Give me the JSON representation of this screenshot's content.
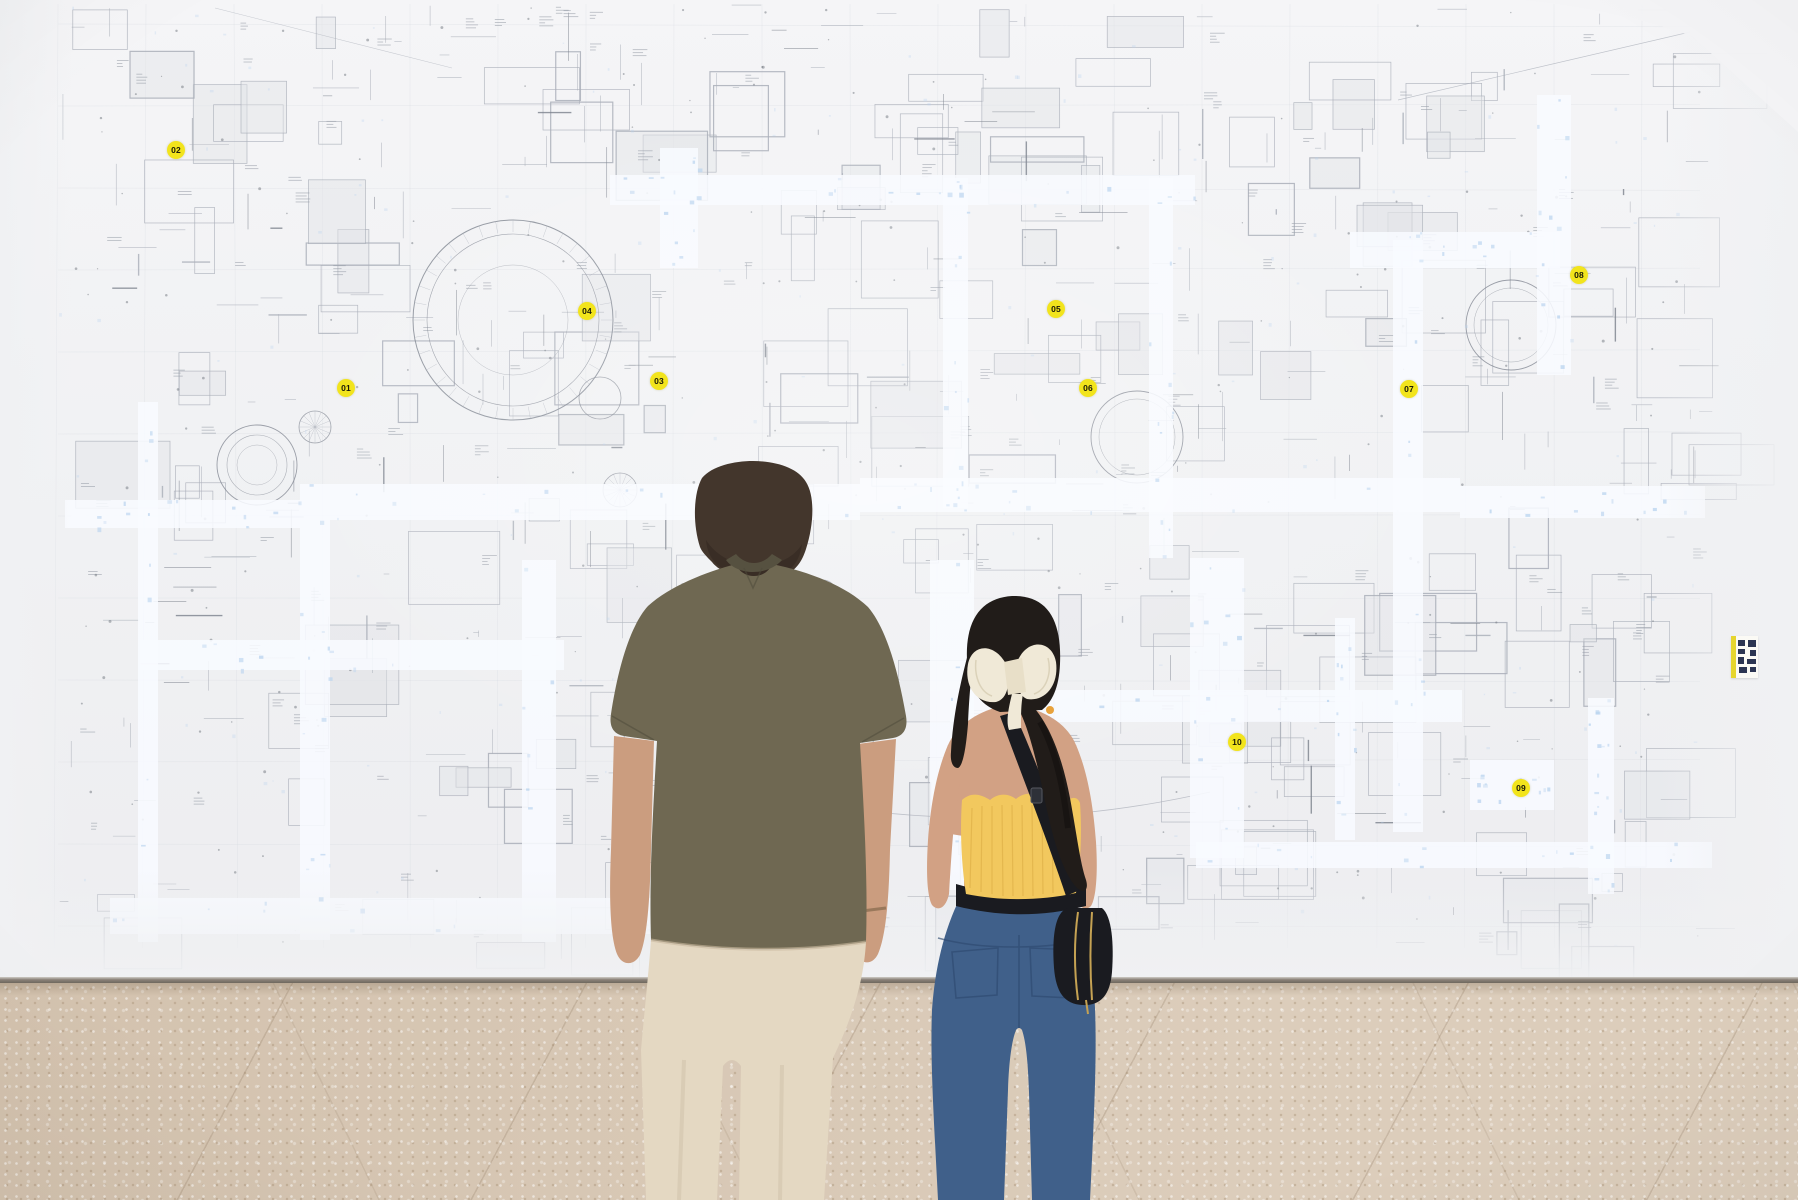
{
  "markers": {
    "items": [
      {
        "label": "01",
        "x": 346,
        "y": 388
      },
      {
        "label": "02",
        "x": 176,
        "y": 150
      },
      {
        "label": "03",
        "x": 659,
        "y": 381
      },
      {
        "label": "04",
        "x": 587,
        "y": 311
      },
      {
        "label": "05",
        "x": 1056,
        "y": 309
      },
      {
        "label": "06",
        "x": 1088,
        "y": 388
      },
      {
        "label": "07",
        "x": 1409,
        "y": 389
      },
      {
        "label": "08",
        "x": 1579,
        "y": 275
      },
      {
        "label": "09",
        "x": 1521,
        "y": 788
      },
      {
        "label": "10",
        "x": 1237,
        "y": 742
      }
    ]
  },
  "palette": {
    "wall_top": "#f5f5f7",
    "wall_bottom": "#ededf0",
    "mural_line": "#a9aeb8",
    "mural_line_dark": "#7c828d",
    "mural_fill": "#e2e4e8",
    "corridor": "#f8fbff",
    "corridor_speck": "#b7d2ee",
    "marker_bg": "#f2e41c",
    "marker_text": "#191908",
    "floor_base": "#d3c2ae",
    "floor_light": "#dccdbb",
    "base_line": "#8a8178",
    "label_bg": "#fbfaf5",
    "label_stripe": "#e6d52e",
    "label_glyph": "#2c3552",
    "man_hair": "#43362c",
    "man_skin": "#cb9d7f",
    "man_shirt": "#6f6852",
    "man_shirt_dark": "#565140",
    "man_pants": "#e4d8c2",
    "woman_hair": "#211c19",
    "woman_skin": "#d2a184",
    "woman_top": "#f2c85e",
    "woman_jeans": "#40608a",
    "woman_bow": "#f0e9d7",
    "belt_bag": "#1a1b20",
    "bag_zip": "#c5a253"
  }
}
